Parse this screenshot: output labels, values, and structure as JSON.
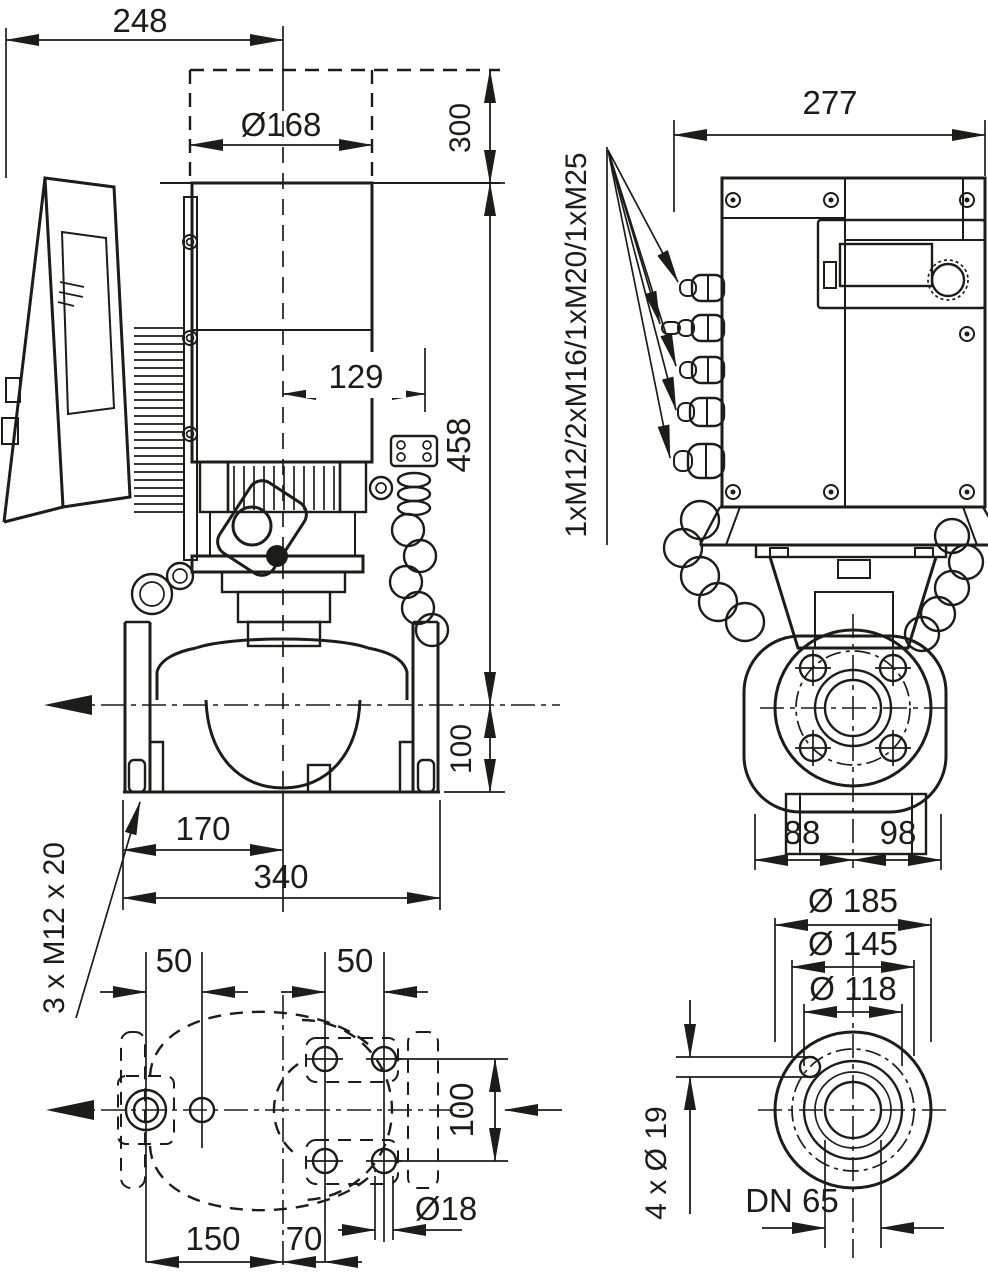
{
  "drawing": {
    "colors": {
      "ink": "#1c1c1a",
      "background": "#ffffff"
    },
    "side_view": {
      "dim_overall_width": "248",
      "dim_removal_clearance": "300",
      "dim_motor_diameter": "Ø168",
      "dim_center_to_module_edge": "129",
      "dim_motor_top_to_center": "458",
      "dim_center_to_base": "100",
      "dim_left_flange_to_center": "170",
      "dim_base_length": "340",
      "label_foot_thread": "3 x M12 x 20"
    },
    "front_view": {
      "dim_overall_width": "277",
      "label_cable_glands": "1xM12/2xM16/1xM20/1xM25",
      "dim_center_to_left": "88",
      "dim_center_to_right": "98"
    },
    "plan_view": {
      "dim_left_hole_pitch": "50",
      "dim_right_hole_pitch": "50",
      "dim_hole_row_spacing": "100",
      "dim_hole_diameter": "Ø18",
      "dim_center_to_left_holes": "150",
      "dim_center_to_right_holes": "70"
    },
    "flange_view": {
      "dim_flange_od": "Ø 185",
      "dim_bolt_circle": "Ø 145",
      "dim_raised_face": "Ø 118",
      "label_bolt_holes": "4 x Ø 19",
      "label_nominal_diameter": "DN 65"
    }
  }
}
